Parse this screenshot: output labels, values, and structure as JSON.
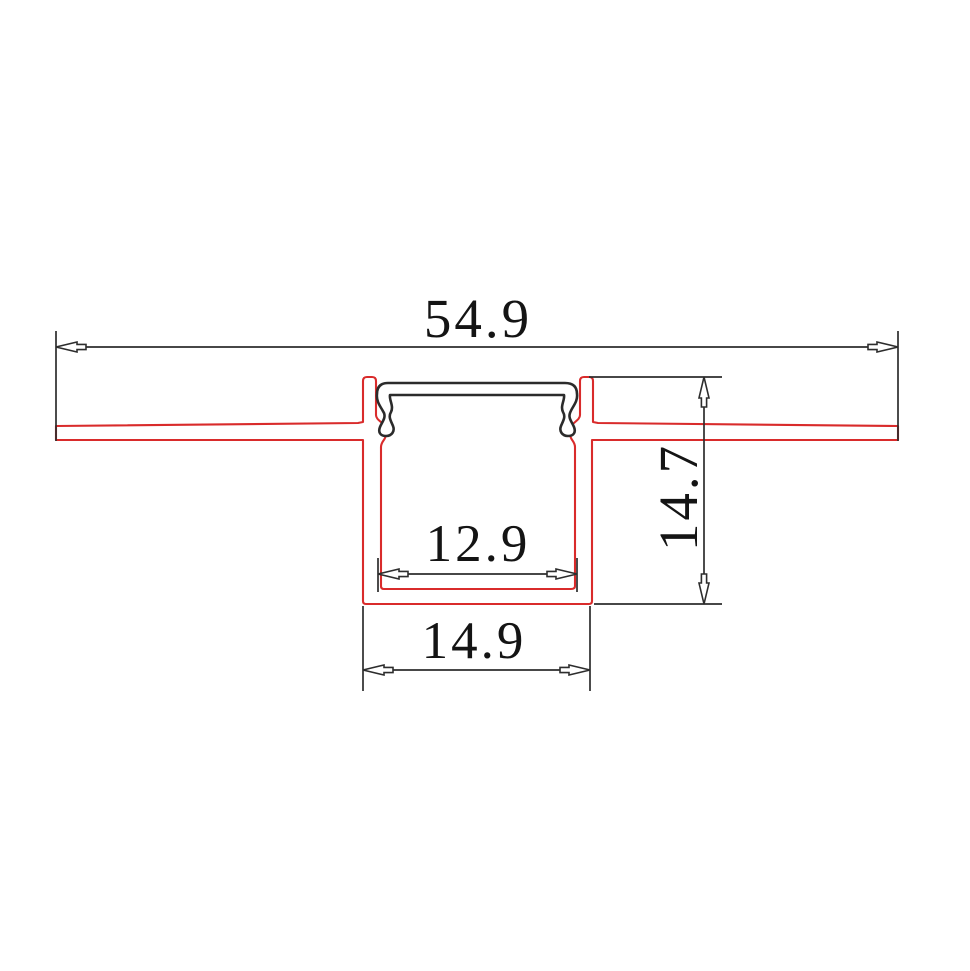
{
  "drawing": {
    "type": "technical-cross-section",
    "subject": "recessed-led-profile-cross-section",
    "labels": {
      "overall_width": "54.9",
      "profile_height": "14.7",
      "inner_width": "12.9",
      "outer_width": "14.9"
    },
    "values": {
      "overall_width": 54.9,
      "profile_height": 14.7,
      "inner_width": 12.9,
      "outer_width": 14.9
    },
    "colors": {
      "profile_outline": "#d92b2b",
      "cover_outline": "#2b2b2b",
      "dimension_lines": "#2d2d2d",
      "text": "#141414",
      "background": "#ffffff"
    }
  }
}
